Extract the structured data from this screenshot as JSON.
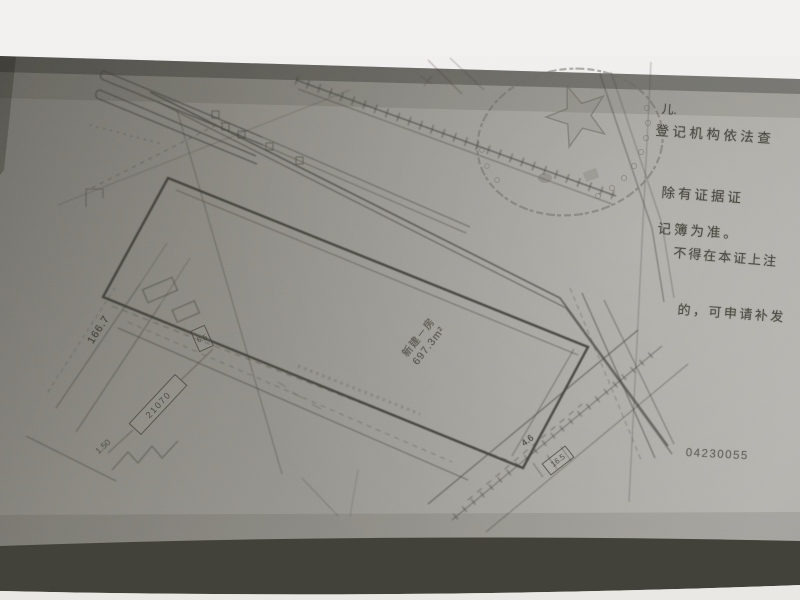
{
  "photo": {
    "description": "Slanted photograph of a photocopied cadastral site-plan page (certificate attachment)",
    "background_top_color": "#f3f1f0",
    "background_bottom_color": "#e8e6e2",
    "paper_color": "#95938c",
    "page_edge_shadow_color": "#43423a",
    "ink_color": "#45443e"
  },
  "certificate_notes": {
    "fragment": "儿.",
    "lines": [
      "登记机构依法查",
      "除有证据证",
      "记簿为准。",
      "不得在本证上注",
      "的，可申请补发"
    ]
  },
  "serial_number": "04230055",
  "plan_annotations": {
    "building_label": "新建－房",
    "building_area": "697.3m²",
    "boundary_dim": "166.7",
    "parcel_box": "21070",
    "edge_dim": "16.5",
    "small_dim": "4.6",
    "gate_dim": "6.5",
    "offset_dim": "1.50"
  },
  "seal": {
    "type": "circular official seal with five-pointed star (photocopied, faint)",
    "color": "#6e6c62"
  }
}
